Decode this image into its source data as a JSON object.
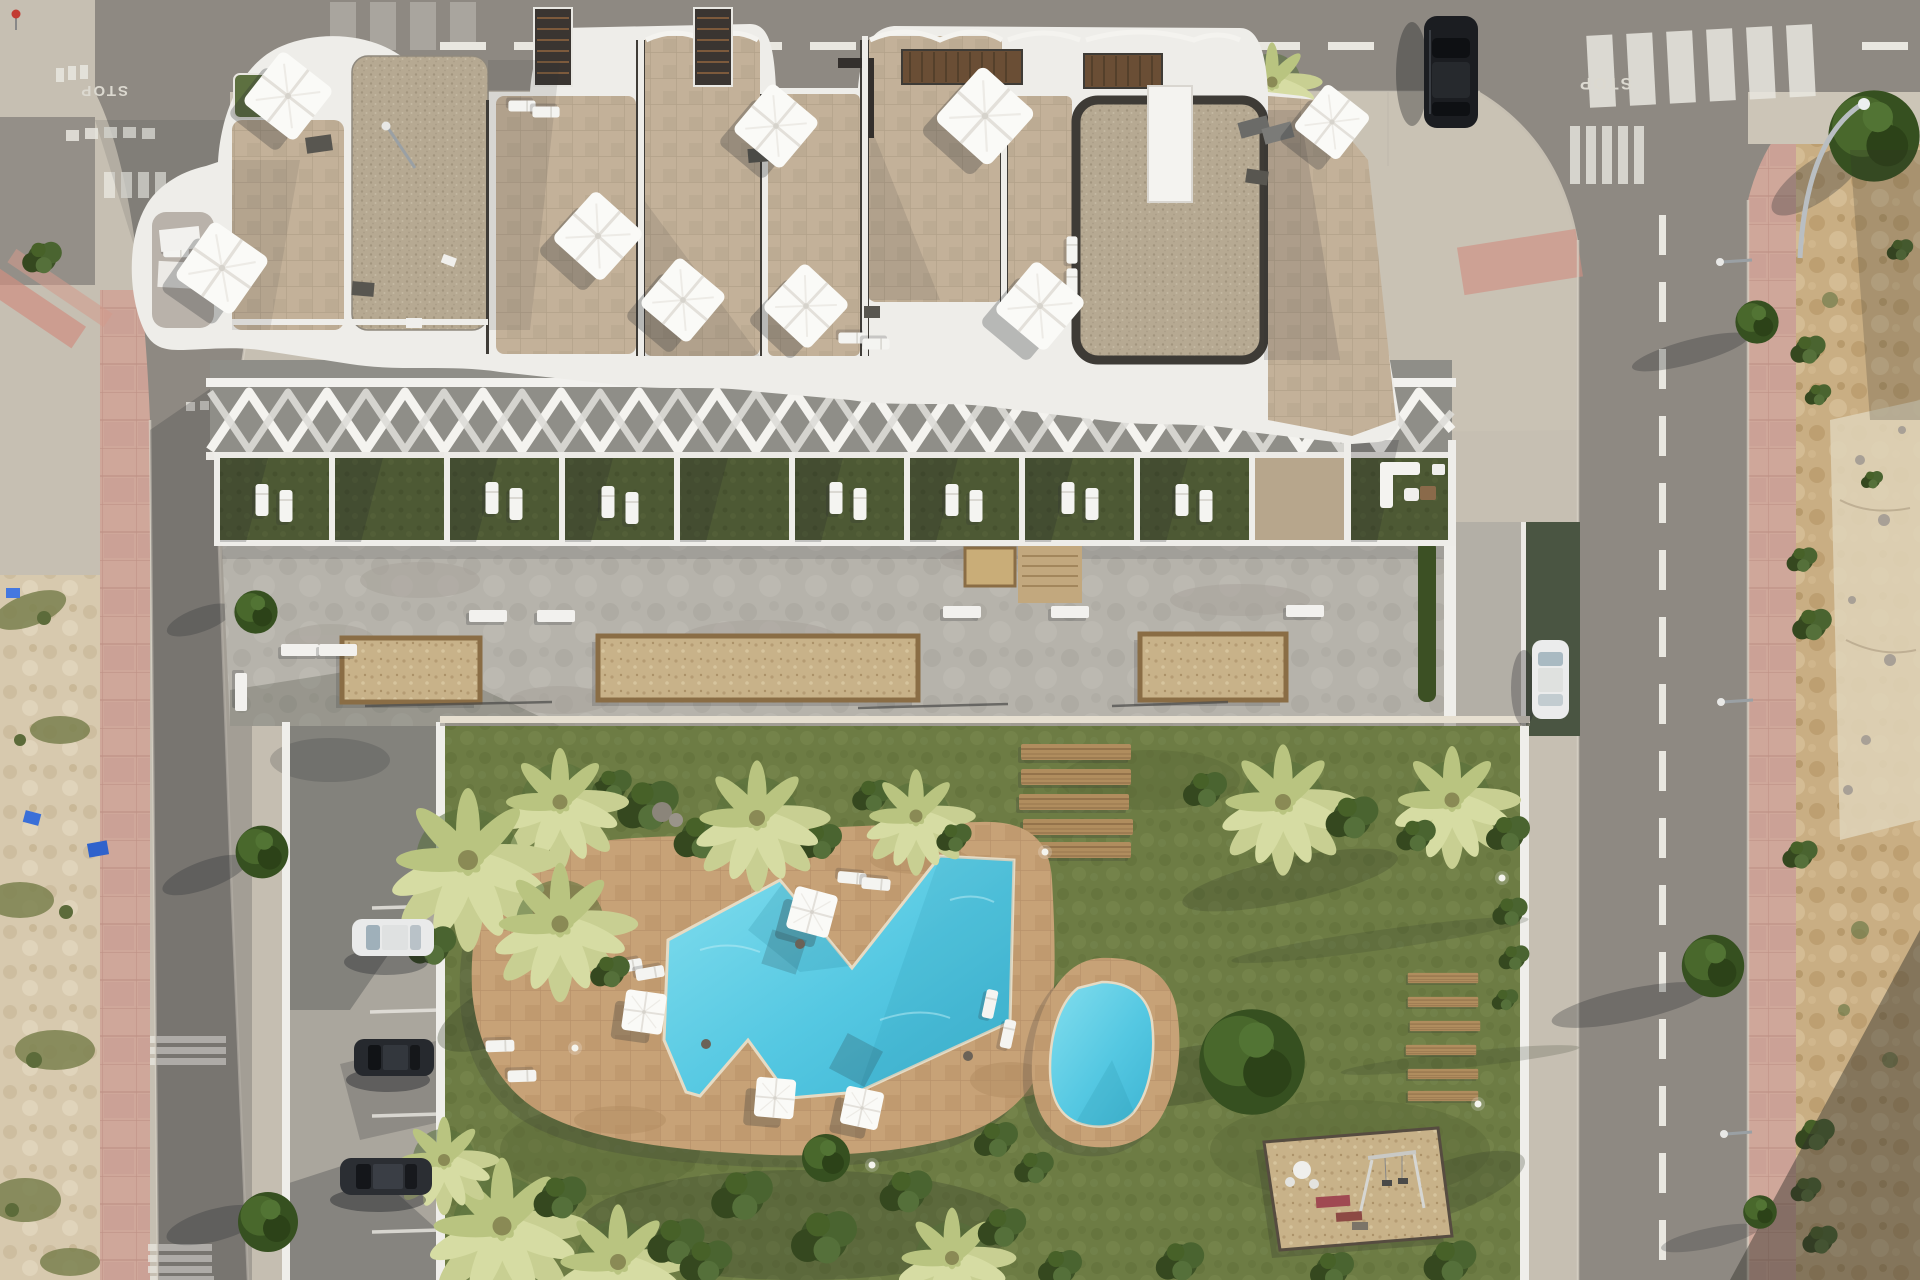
{
  "scene": {
    "type": "aerial architectural render",
    "subject": "apartment residence with rooftop terraces, communal garden, swimming pools and parking",
    "road_marking_text": "STOP"
  },
  "palette": {
    "lawn": "#6d7c44",
    "pool_water": "#49c5e0",
    "pool_deck": "#c7a277",
    "roof_tile": "#c3b199",
    "gravel": "#b6a992",
    "white_structure": "#efeee9",
    "concrete_plaza": "#b6b3ab",
    "asphalt": "#8e8982",
    "sidewalk": "#c6bfb2",
    "pink_sidewalk": "#cfa79a",
    "dirt_left": "#d7c9ae",
    "dirt_right": "#c9ae83",
    "planter_sand": "#cfb37c",
    "wood": "#b08d5e",
    "mulch": "#c8b289",
    "terrace_grass": "#4d5934",
    "vegetation_dark": "#3d5226",
    "palm_yellow": "#c8cf92",
    "driveway_green": "#4a5542",
    "marking_white": "#e9e7e0"
  },
  "building": {
    "rooftop_parasols": 9,
    "gravel_roof_patches": 2,
    "stair_towers": 2,
    "pergolas": 2,
    "ground_floor_terraces": 10
  },
  "amenities": {
    "main_pool": 1,
    "kids_pool": 1,
    "pool_parasols": 4,
    "playground": 1,
    "plaza_planters": 3,
    "plaza_benches": 8,
    "wooden_deck_planks": 5,
    "wooden_loungers": 6
  },
  "vehicles": {
    "parked_cars": [
      {
        "color": "dark",
        "location": "top road"
      },
      {
        "color": "white",
        "location": "side driveway"
      },
      {
        "color": "white",
        "location": "parking strip"
      },
      {
        "color": "dark",
        "location": "parking strip"
      },
      {
        "color": "dark",
        "location": "parking strip"
      }
    ]
  },
  "roads": {
    "stop_markings": 2,
    "crosswalks": 6,
    "center_line": "white dashed"
  }
}
